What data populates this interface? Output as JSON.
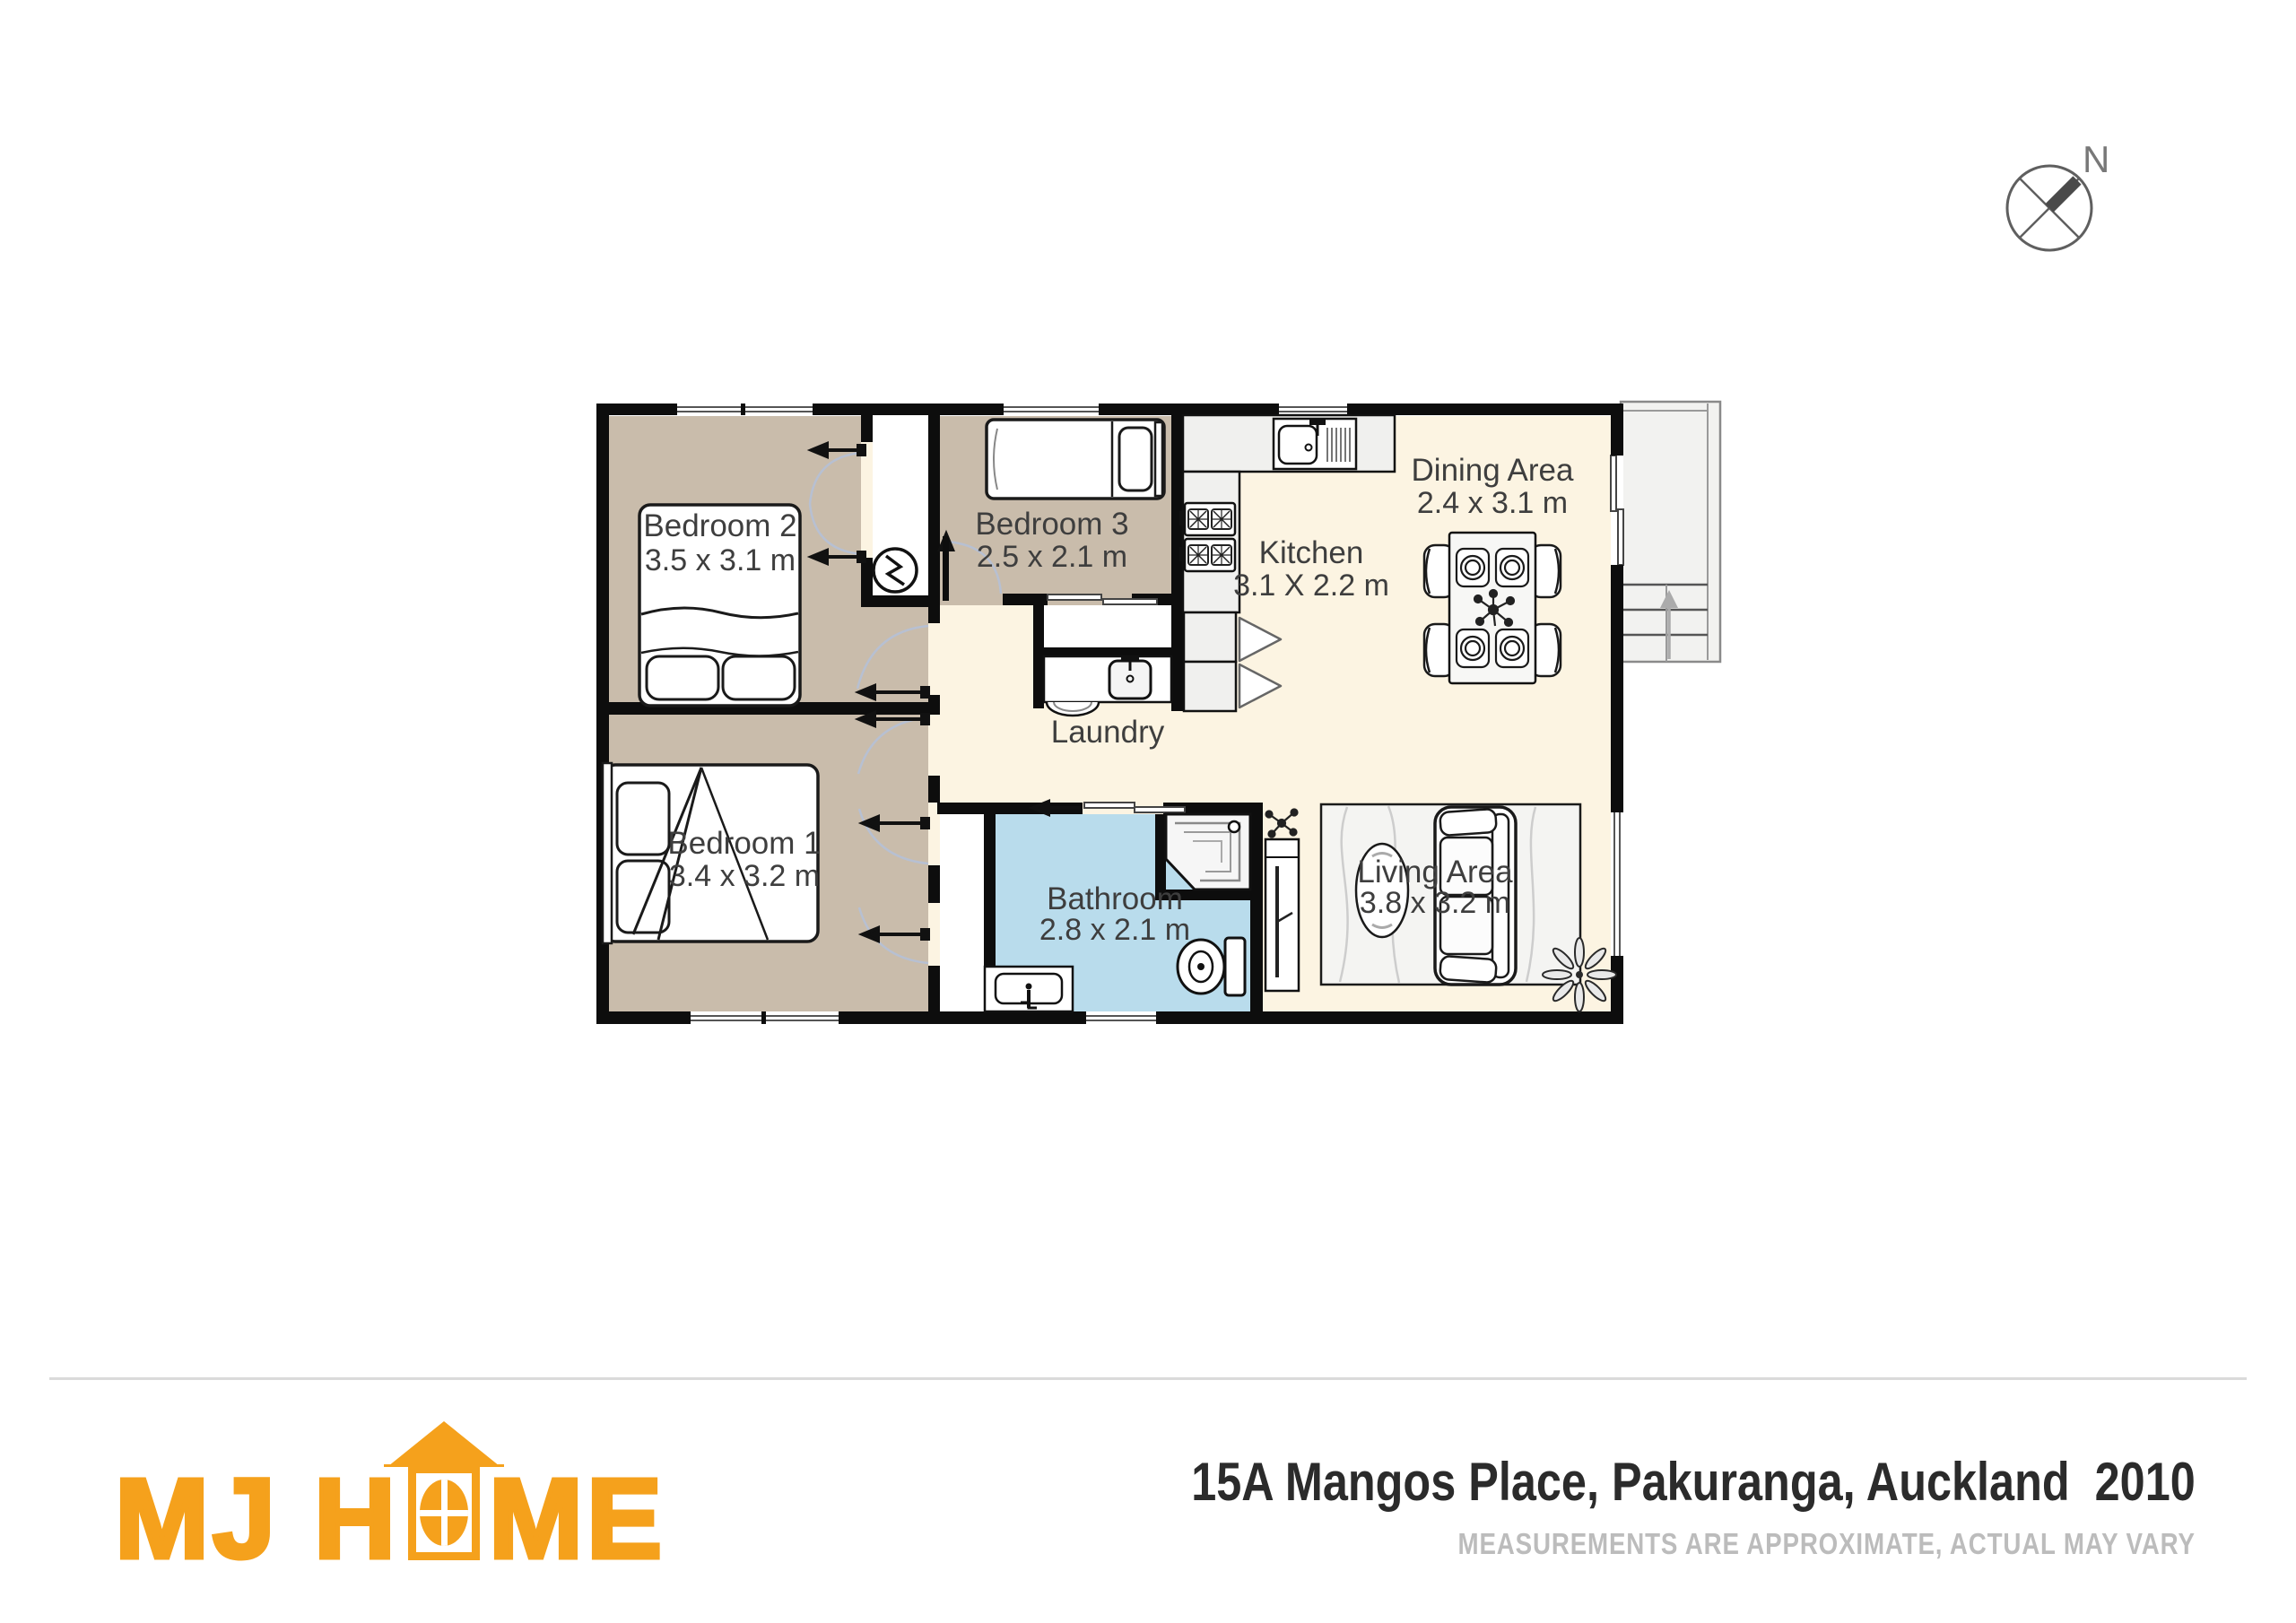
{
  "plan": {
    "rooms": {
      "bedroom2": {
        "name": "Bedroom 2",
        "dims": "3.5 x 3.1 m"
      },
      "bedroom3": {
        "name": "Bedroom 3",
        "dims": "2.5 x 2.1 m"
      },
      "bedroom1": {
        "name": "Bedroom 1",
        "dims": "3.4 x 3.2 m"
      },
      "kitchen": {
        "name": "Kitchen",
        "dims": "3.1 X 2.2 m"
      },
      "dining": {
        "name": "Dining Area",
        "dims": "2.4 x 3.1 m"
      },
      "living": {
        "name": "Living Area",
        "dims": "3.8 x 3.2 m"
      },
      "bathroom": {
        "name": "Bathroom",
        "dims": "2.8 x 2.1 m"
      },
      "laundry": {
        "name": "Laundry"
      }
    },
    "compass": {
      "label": "N"
    }
  },
  "footer": {
    "logo": {
      "part1": "MJ H",
      "part2": "ME"
    },
    "address": "15A Mangos Place, Pakuranga, Auckland  2010",
    "disclaimer": "MEASUREMENTS ARE APPROXIMATE, ACTUAL MAY VARY"
  },
  "colors": {
    "accent_orange": "#F5A11C",
    "room_tan": "#c9bcab",
    "floor_cream": "#fcf4e2",
    "bath_blue": "#b9dcec",
    "wall_black": "#0d0d0d"
  }
}
